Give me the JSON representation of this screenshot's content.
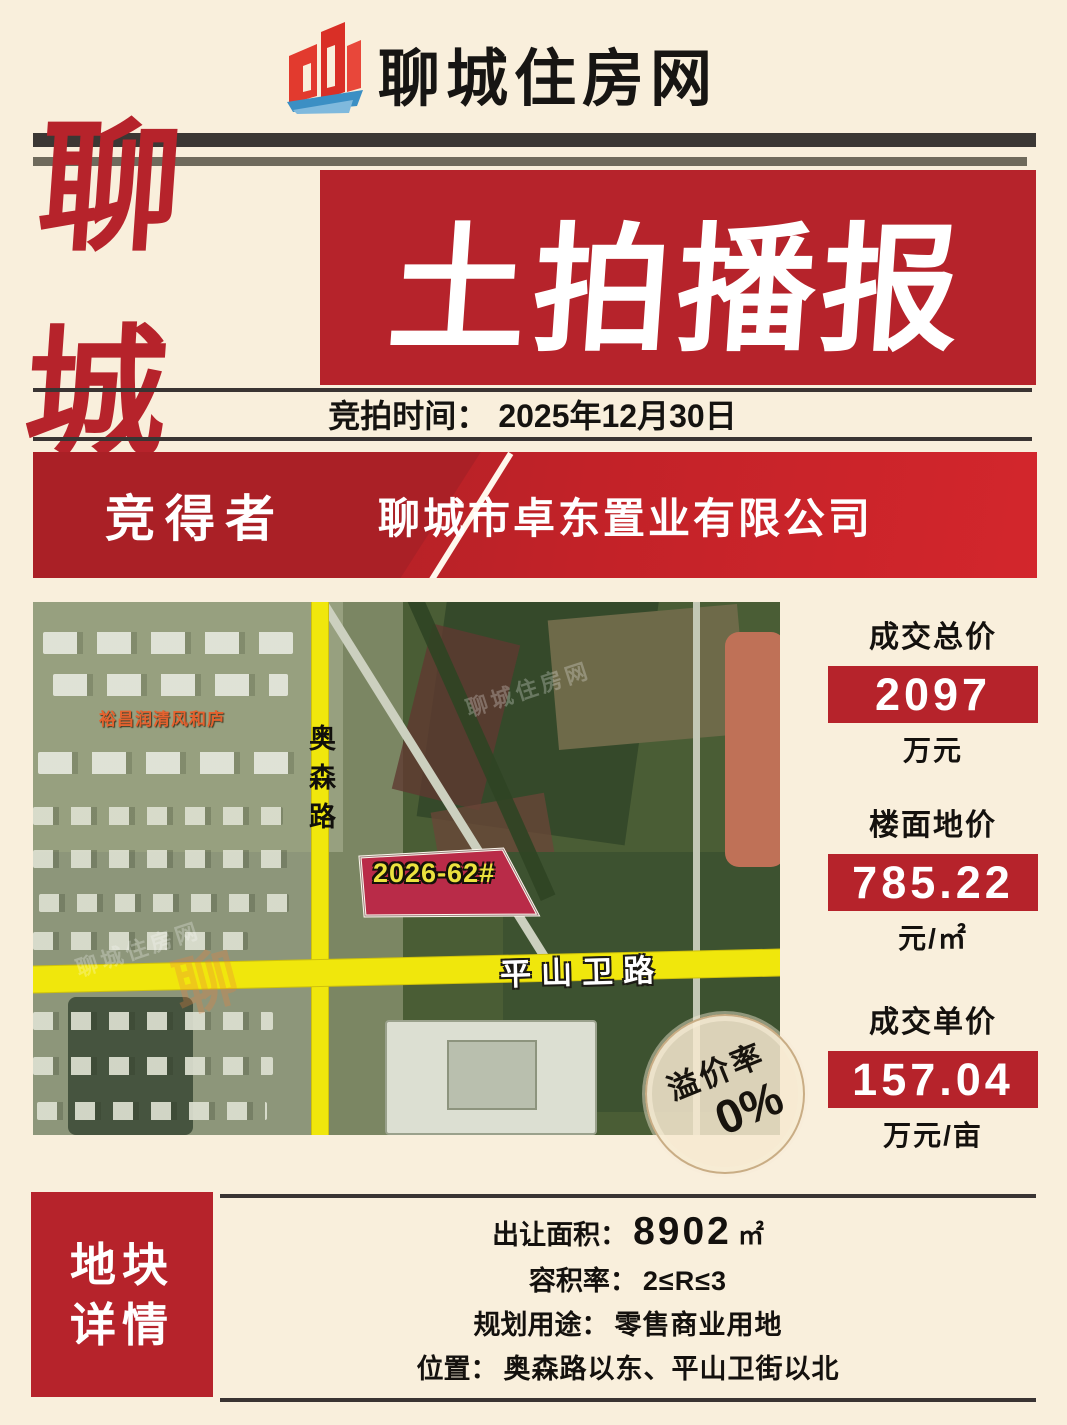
{
  "colors": {
    "accent_red": "#b6232b",
    "bright_red": "#d2252b",
    "cream_bg": "#f9efdc",
    "road_yellow": "#f0e70c",
    "parcel_red": "#b92b48"
  },
  "header": {
    "site_name": "聊城住房网"
  },
  "hero": {
    "left_title": "聊城",
    "right_title": "土拍播报"
  },
  "auction_time": {
    "label": "竞拍时间：",
    "value": "2025年12月30日"
  },
  "winner": {
    "label": "竞得者",
    "name": "聊城市卓东置业有限公司"
  },
  "map": {
    "community_label": "裕昌润清风和庐",
    "road_vertical": "奥森路",
    "road_horizontal": "平山卫路",
    "parcel_label": "2026-62#",
    "watermark_text": "聊城住房网",
    "watermark_logo": "聊"
  },
  "stats": [
    {
      "label": "成交总价",
      "value": "2097",
      "unit": "万元"
    },
    {
      "label": "楼面地价",
      "value": "785.22",
      "unit": "元/㎡"
    },
    {
      "label": "成交单价",
      "value": "157.04",
      "unit": "万元/亩"
    }
  ],
  "premium_badge": {
    "label": "溢价率",
    "value": "0%"
  },
  "details": {
    "title_line1": "地块",
    "title_line2": "详情",
    "rows": [
      {
        "label": "出让面积：",
        "value": "8902",
        "unit": "㎡"
      },
      {
        "label": "容积率：",
        "value": "2≤R≤3",
        "unit": ""
      },
      {
        "label": "规划用途：",
        "value": "零售商业用地",
        "unit": ""
      },
      {
        "label": "位置：",
        "value": "奥森路以东、平山卫街以北",
        "unit": ""
      }
    ]
  }
}
